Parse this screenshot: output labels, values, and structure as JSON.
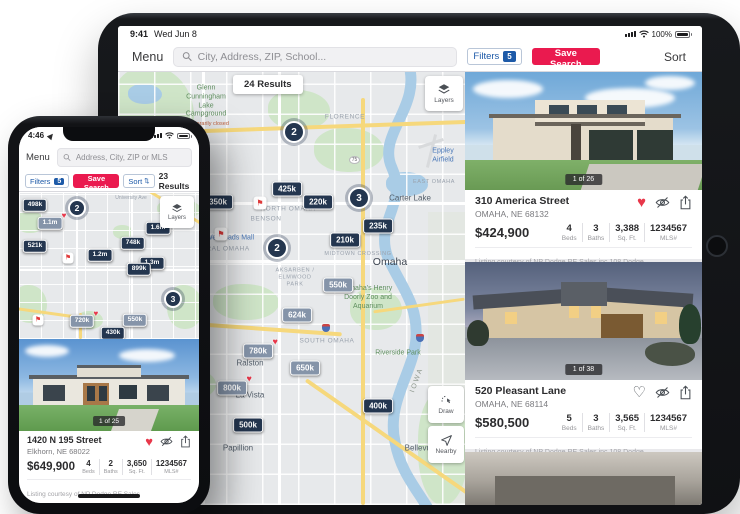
{
  "icons": {
    "heart_filled": "♥",
    "heart_outline": "♡",
    "flag": "⚑",
    "sort_arrows": "⇅"
  },
  "colors": {
    "marker_navy": "#24364f",
    "marker_grey": "#8594a9",
    "save_search_red": "#ea1a4f",
    "filters_blue": "#1d5aa8",
    "favorite_red": "#e8374a"
  },
  "stats": {
    "beds": "Beds",
    "baths": "Baths",
    "sqft": "Sq. Ft.",
    "mls": "MLS#"
  },
  "ipad": {
    "status": {
      "time": "9:41",
      "date": "Wed Jun 8",
      "battery": "100%"
    },
    "nav": {
      "menu": "Menu",
      "search_placeholder": "City, Address, ZIP, School...",
      "filters": "Filters",
      "filters_count": "5",
      "save_search": "Save Search",
      "sort": "Sort"
    },
    "map": {
      "results": "24 Results",
      "layers": "Layers",
      "draw": "Draw",
      "nearby": "Nearby",
      "shield": "75",
      "clusters": [
        "2",
        "3",
        "2"
      ],
      "markers": [
        {
          "label": "425k"
        },
        {
          "label": "350k"
        },
        {
          "label": "220k"
        },
        {
          "label": "235k"
        },
        {
          "label": "210k"
        },
        {
          "label": "550k"
        },
        {
          "label": "624k"
        },
        {
          "label": "780k"
        },
        {
          "label": "650k"
        },
        {
          "label": "800k"
        },
        {
          "label": "400k"
        },
        {
          "label": "500k"
        }
      ],
      "labels": [
        "Glenn Cunningham Lake Campground",
        "Temporarily closed",
        "FLORENCE",
        "Eppley Airfield",
        "Carter Lake",
        "EAST OMAHA",
        "NORTH OMAHA",
        "BENSON",
        "Westroads Mall",
        "CENTRAL OMAHA",
        "MIDTOWN CROSSING",
        "Omaha",
        "AKSARBEN / ELMWOOD PARK",
        "Omaha's Henry Doorly Zoo and Aquarium",
        "SOUTH OMAHA",
        "Riverside Park",
        "Ralston",
        "La Vista",
        "Papillion",
        "Bellevue",
        "IOWA"
      ]
    },
    "cards": [
      {
        "badge": "1 of 26",
        "address": "310 America Street",
        "city": "OMAHA, NE 68132",
        "price": "$424,900",
        "beds": "4",
        "baths": "3",
        "sqft": "3,388",
        "mls": "1234567",
        "courtesy": "Listing courtesy of NP Dodge RE Sales inc 108 Dodge"
      },
      {
        "badge": "1 of 38",
        "address": "520 Pleasant Lane",
        "city": "OMAHA, NE 68114",
        "price": "$580,500",
        "beds": "5",
        "baths": "3",
        "sqft": "3,565",
        "mls": "1234567",
        "courtesy": "Listing courtesy of NP Dodge RE Sales inc 108 Dodge"
      }
    ]
  },
  "iphone": {
    "status": {
      "time": "4:46"
    },
    "nav": {
      "menu": "Menu",
      "search_placeholder": "Address, City, ZIP or MLS"
    },
    "filter_bar": {
      "filters": "Filters",
      "filters_count": "5",
      "save_search": "Save Search",
      "sort": "Sort",
      "results": "23 Results"
    },
    "map": {
      "layers": "Layers",
      "clusters": [
        "2",
        "3"
      ],
      "markers": [
        {
          "label": "498k"
        },
        {
          "label": "1.1m"
        },
        {
          "label": "1.6m"
        },
        {
          "label": "748k"
        },
        {
          "label": "521k"
        },
        {
          "label": "1.2m"
        },
        {
          "label": "1.3m"
        },
        {
          "label": "899k"
        },
        {
          "label": "720k"
        },
        {
          "label": "550k"
        },
        {
          "label": "430k"
        }
      ],
      "labels": [
        "University Ave"
      ]
    },
    "card": {
      "badge": "1 of 25",
      "address": "1420 N 195 Street",
      "city": "Elkhorn, NE 68022",
      "price": "$649,900",
      "beds": "4",
      "baths": "2",
      "sqft": "3,650",
      "mls": "1234567",
      "courtesy": "Listing courtesy of NP Dodge RE Sales"
    }
  }
}
